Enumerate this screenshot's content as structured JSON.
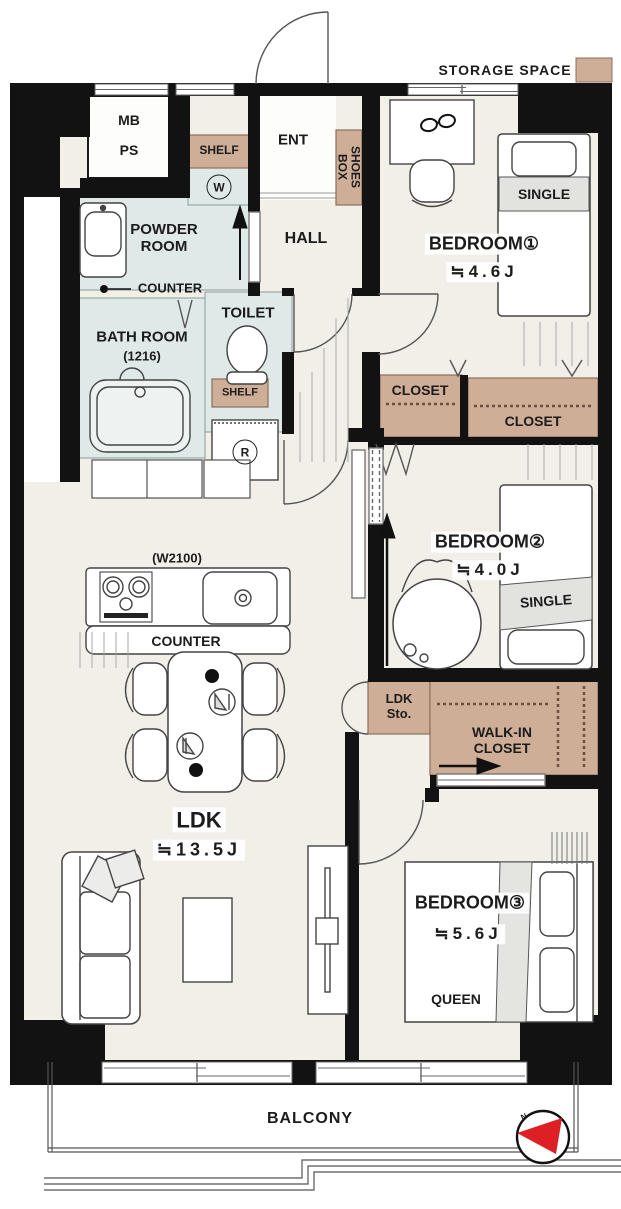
{
  "legend": {
    "storage_space": "STORAGE SPACE"
  },
  "labels": {
    "mb": "MB",
    "ps": "PS",
    "shelf_laundry": "SHELF",
    "washer": "W",
    "entrance": "ENT",
    "shoes_box": "SHOES BOX",
    "hall": "HALL",
    "powder_room": "POWDER ROOM",
    "powder_counter": "COUNTER",
    "bath_room": "BATH ROOM",
    "bath_size": "(1216)",
    "toilet": "TOILET",
    "shelf_toilet": "SHELF",
    "refrigerator": "R",
    "kitchen_width": "(W2100)",
    "kitchen_counter": "COUNTER",
    "balcony": "BALCONY",
    "compass_north": "N"
  },
  "rooms": {
    "ldk": {
      "name": "LDK",
      "size": "≒13.5J"
    },
    "bedroom1": {
      "name": "BEDROOM①",
      "size": "≒4.6J",
      "bed": "SINGLE"
    },
    "bedroom2": {
      "name": "BEDROOM②",
      "size": "≒4.0J",
      "bed": "SINGLE"
    },
    "bedroom3": {
      "name": "BEDROOM③",
      "size": "≒5.6J",
      "bed": "QUEEN"
    },
    "closet_a": "CLOSET",
    "closet_b": "CLOSET",
    "ldk_storage": "LDK Sto.",
    "walk_in_closet": "WALK-IN CLOSET"
  },
  "colors": {
    "storage_accent": "#cfae97",
    "wet_area": "#dfe9e8",
    "floor": "#f1efe8",
    "wall": "#121212",
    "compass_red": "#dd2025"
  }
}
